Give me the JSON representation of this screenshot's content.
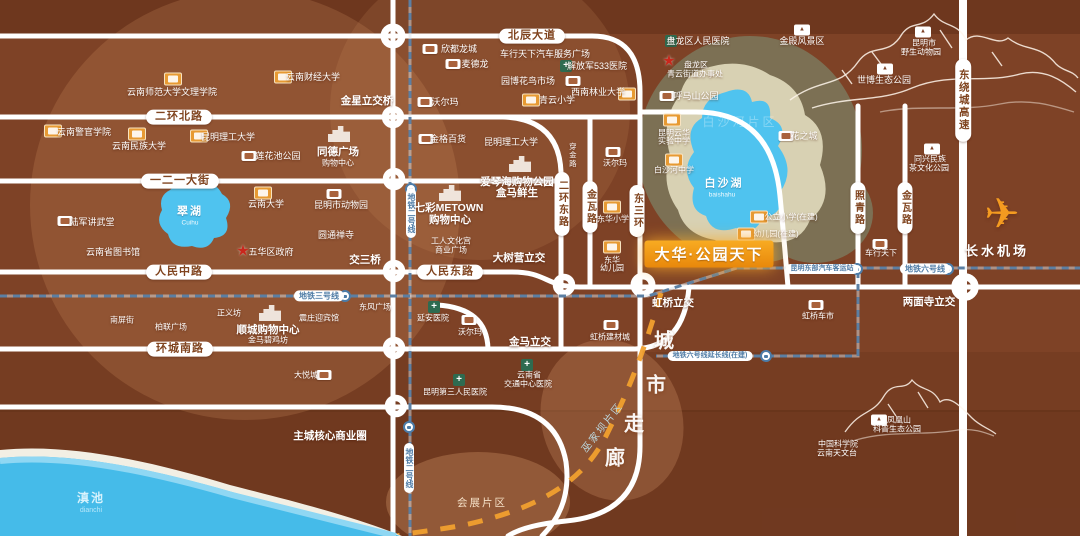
{
  "project": {
    "name": "大华·公园天下"
  },
  "colors": {
    "base": "#7e4226",
    "road": "#ffffff",
    "metro_dash": "#9db3c9",
    "corridor_dash": "#f1a02e",
    "lake_blue": "#4fc3ef",
    "dianchi_blue": "#45bbe9",
    "banner_orange": "#f0930e",
    "olive_ring": "#7c7054",
    "cream_ring": "#d8d1b3",
    "school_icon": "#e79a33",
    "hospital_icon": "#2e6b50",
    "star_icon": "#c9271c"
  },
  "labels": [
    {
      "t": "北辰大道",
      "x": 532,
      "y": 36,
      "c": "pill-h",
      "n": "road-label-beichen-avenue"
    },
    {
      "t": "二环北路",
      "x": 179,
      "y": 117,
      "c": "pill-h",
      "n": "road-label-erhuan-north"
    },
    {
      "t": "一二一大街",
      "x": 180,
      "y": 181,
      "c": "pill-h",
      "n": "road-label-121-street"
    },
    {
      "t": "人民中路",
      "x": 179,
      "y": 272,
      "c": "pill-h",
      "n": "road-label-renmin-middle"
    },
    {
      "t": "人民东路",
      "x": 450,
      "y": 272,
      "c": "pill-h",
      "n": "road-label-renmin-east"
    },
    {
      "t": "环城南路",
      "x": 180,
      "y": 349,
      "c": "pill-h",
      "n": "road-label-huancheng-south"
    },
    {
      "t": "二环东路",
      "x": 562,
      "y": 204,
      "c": "pill-v",
      "n": "road-label-erhuan-east"
    },
    {
      "t": "金瓦路",
      "x": 590,
      "y": 207,
      "c": "pill-v",
      "n": "road-label-jinwa-west"
    },
    {
      "t": "东三环",
      "x": 637,
      "y": 211,
      "c": "pill-v",
      "n": "road-label-dongsanhuan"
    },
    {
      "t": "照青路",
      "x": 858,
      "y": 208,
      "c": "pill-v",
      "n": "road-label-zhaoqing"
    },
    {
      "t": "金瓦路",
      "x": 905,
      "y": 208,
      "c": "pill-v",
      "n": "road-label-jinwa-east"
    },
    {
      "t": "东绕城高速",
      "x": 963,
      "y": 100,
      "c": "pill-v hw",
      "n": "road-label-east-ring-expressway"
    },
    {
      "t": "穿金路",
      "x": 572,
      "y": 155,
      "c": "v-text",
      "n": "road-label-chuanjin"
    },
    {
      "t": "金星立交桥",
      "x": 367,
      "y": 101,
      "c": "md",
      "n": "interchange-jinxing"
    },
    {
      "t": "交三桥",
      "x": 365,
      "y": 260,
      "c": "md",
      "n": "interchange-jiaosanqiao"
    },
    {
      "t": "大树营立交",
      "x": 519,
      "y": 258,
      "c": "md",
      "n": "interchange-dashuying"
    },
    {
      "t": "金马立交",
      "x": 530,
      "y": 342,
      "c": "md",
      "n": "interchange-jinma"
    },
    {
      "t": "虹桥立交",
      "x": 673,
      "y": 303,
      "c": "md",
      "n": "interchange-hongqiao"
    },
    {
      "t": "两面寺立交",
      "x": 929,
      "y": 302,
      "c": "md",
      "n": "interchange-liangmiansi"
    },
    {
      "t": "主城核心商业圈",
      "x": 330,
      "y": 436,
      "c": "md",
      "n": "main-city-core-business-circle"
    },
    {
      "t": "地铁三号线",
      "x": 319,
      "y": 296,
      "c": "metro-pill",
      "n": "metro-line3-label"
    },
    {
      "t": "地铁二号线",
      "x": 411,
      "y": 213,
      "c": "metro-v",
      "n": "metro-line2-label"
    },
    {
      "t": "地铁二号线",
      "x": 409,
      "y": 468,
      "c": "metro-v",
      "n": "metro-line2-label-south"
    },
    {
      "t": "昆明东部汽车客运站",
      "x": 822,
      "y": 269,
      "c": "metro-pill tiny",
      "n": "east-bus-station-label"
    },
    {
      "t": "地铁六号线",
      "x": 925,
      "y": 269,
      "c": "metro-pill",
      "n": "metro-line6-label"
    },
    {
      "t": "地铁六号线延长线(在建)",
      "x": 710,
      "y": 356,
      "c": "metro-pill tiny",
      "n": "metro-line6-extension-label"
    },
    {
      "t": "云南师范大学文理学院",
      "x": 172,
      "y": 92,
      "n": "poi-ynnu-arts-science"
    },
    {
      "t": "云南财经大学",
      "x": 313,
      "y": 77,
      "n": "poi-yufe"
    },
    {
      "t": "云南警官学院",
      "x": 84,
      "y": 132,
      "n": "poi-yunnan-police-college"
    },
    {
      "t": "云南民族大学",
      "x": 139,
      "y": 146,
      "n": "poi-yunnan-minzu-univ"
    },
    {
      "t": "昆明理工大学",
      "x": 228,
      "y": 137,
      "n": "poi-kust"
    },
    {
      "t": "莲花池公园",
      "x": 278,
      "y": 156,
      "n": "poi-lianhuachi-park"
    },
    {
      "t": "同德广场",
      "x": 338,
      "y": 152,
      "c": "md",
      "n": "poi-tongde-plaza"
    },
    {
      "t": "购物中心",
      "x": 338,
      "y": 163,
      "c": "sm",
      "n": "poi-tongde-mall"
    },
    {
      "t": "欣都龙城",
      "x": 459,
      "y": 49,
      "n": "poi-xindu-longcheng"
    },
    {
      "t": "麦德龙",
      "x": 475,
      "y": 64,
      "n": "poi-metro-market"
    },
    {
      "t": "车行天下汽车服务广场",
      "x": 545,
      "y": 54,
      "n": "poi-auto-service-plaza"
    },
    {
      "t": "解放军533医院",
      "x": 597,
      "y": 66,
      "n": "poi-pla-533-hospital"
    },
    {
      "t": "园博花鸟市场",
      "x": 528,
      "y": 81,
      "n": "poi-yuanbo-flower-bird-market"
    },
    {
      "t": "青云小学",
      "x": 557,
      "y": 100,
      "n": "poi-qingyun-primary"
    },
    {
      "t": "西南林业大学",
      "x": 598,
      "y": 92,
      "n": "poi-swfu"
    },
    {
      "t": "呼马山公园",
      "x": 696,
      "y": 96,
      "n": "poi-humashan-park"
    },
    {
      "t": "盘龙区人民医院",
      "x": 698,
      "y": 41,
      "n": "poi-panlong-peoples-hospital"
    },
    {
      "t": "盘龙区",
      "x": 696,
      "y": 65,
      "c": "sm",
      "n": "poi-panlong-district"
    },
    {
      "t": "青云街道办事处",
      "x": 695,
      "y": 74,
      "c": "sm",
      "n": "poi-qingyun-subdistrict-office"
    },
    {
      "t": "沃尔玛",
      "x": 445,
      "y": 102,
      "n": "poi-walmart-north"
    },
    {
      "t": "金格百货",
      "x": 448,
      "y": 139,
      "n": "poi-jinge-department-store"
    },
    {
      "t": "昆明理工大学",
      "x": 511,
      "y": 142,
      "n": "poi-kust-campus2"
    },
    {
      "t": "金殿风景区",
      "x": 802,
      "y": 41,
      "n": "poi-golden-temple-scenic"
    },
    {
      "t": "昆明市",
      "x": 924,
      "y": 43,
      "c": "sm",
      "n": "poi-kunming-city"
    },
    {
      "t": "野生动物园",
      "x": 921,
      "y": 52,
      "c": "sm",
      "n": "poi-wildlife-park"
    },
    {
      "t": "世博生态公园",
      "x": 884,
      "y": 80,
      "n": "poi-expo-eco-park"
    },
    {
      "t": "花之城",
      "x": 804,
      "y": 136,
      "n": "poi-flower-city"
    },
    {
      "t": "同兴民族",
      "x": 930,
      "y": 159,
      "c": "sm",
      "n": "poi-tongxing-minzu"
    },
    {
      "t": "茶文化公园",
      "x": 929,
      "y": 168,
      "c": "sm",
      "n": "poi-tea-culture-park"
    },
    {
      "t": "陆军讲武堂",
      "x": 92,
      "y": 222,
      "n": "poi-army-academy"
    },
    {
      "t": "翠湖",
      "x": 190,
      "y": 212,
      "c": "lake",
      "n": "lake-label-cuihu"
    },
    {
      "t": "Cuihu",
      "x": 190,
      "y": 223,
      "c": "latin",
      "n": "lake-label-cuihu-pinyin"
    },
    {
      "t": "云南大学",
      "x": 266,
      "y": 204,
      "n": "poi-yunnan-university"
    },
    {
      "t": "昆明市动物园",
      "x": 341,
      "y": 205,
      "n": "poi-kunming-zoo"
    },
    {
      "t": "云南省图书馆",
      "x": 113,
      "y": 252,
      "n": "poi-yunnan-library"
    },
    {
      "t": "五华区政府",
      "x": 271,
      "y": 252,
      "n": "poi-wuhua-district-gov"
    },
    {
      "t": "圆通禅寺",
      "x": 336,
      "y": 235,
      "n": "poi-yuantong-temple"
    },
    {
      "t": "七彩METOWN",
      "x": 449,
      "y": 208,
      "c": "md",
      "n": "poi-qicai-metown"
    },
    {
      "t": "购物中心",
      "x": 450,
      "y": 220,
      "c": "md",
      "n": "poi-metown-mall"
    },
    {
      "t": "爱琴海购物公园",
      "x": 517,
      "y": 182,
      "c": "md",
      "n": "poi-aegean-shopping-park"
    },
    {
      "t": "盒马鲜生",
      "x": 517,
      "y": 193,
      "c": "md",
      "n": "poi-hema-fresh"
    },
    {
      "t": "工人文化宫",
      "x": 451,
      "y": 241,
      "c": "sm",
      "n": "poi-workers-culture-palace"
    },
    {
      "t": "商业广场",
      "x": 451,
      "y": 250,
      "c": "sm",
      "n": "poi-business-plaza"
    },
    {
      "t": "昆明云华",
      "x": 674,
      "y": 133,
      "c": "sm",
      "n": "poi-yunhua-line1"
    },
    {
      "t": "实验中学",
      "x": 674,
      "y": 141,
      "c": "sm",
      "n": "poi-yunhua-experimental-school"
    },
    {
      "t": "白沙河中学",
      "x": 674,
      "y": 170,
      "c": "sm",
      "n": "poi-baishahe-middle-school"
    },
    {
      "t": "白沙湖",
      "x": 724,
      "y": 184,
      "c": "lake",
      "n": "lake-label-baishahu"
    },
    {
      "t": "baishahu",
      "x": 722,
      "y": 195,
      "c": "latin",
      "n": "lake-label-baishahu-pinyin"
    },
    {
      "t": "公立小学(在建)",
      "x": 791,
      "y": 217,
      "c": "sm",
      "n": "poi-public-primary-under-construction"
    },
    {
      "t": "幼儿园(在建)",
      "x": 776,
      "y": 234,
      "c": "sm",
      "n": "poi-kindergarten-under-construction"
    },
    {
      "t": "沃尔玛",
      "x": 615,
      "y": 163,
      "c": "sm",
      "n": "poi-walmart-east"
    },
    {
      "t": "东华小学",
      "x": 613,
      "y": 219,
      "c": "sm",
      "n": "poi-donghua-primary"
    },
    {
      "t": "东华",
      "x": 612,
      "y": 260,
      "c": "sm",
      "n": "poi-donghua"
    },
    {
      "t": "幼儿园",
      "x": 612,
      "y": 268,
      "c": "sm",
      "n": "poi-donghua-kindergarten"
    },
    {
      "t": "车行天下",
      "x": 881,
      "y": 253,
      "c": "sm",
      "n": "poi-chexing-tianxia"
    },
    {
      "t": "长水机场",
      "x": 997,
      "y": 252,
      "c": "airport",
      "n": "poi-changshui-airport"
    },
    {
      "t": "虹桥车市",
      "x": 818,
      "y": 316,
      "c": "sm",
      "n": "poi-hongqiao-auto-market"
    },
    {
      "t": "虹桥建材城",
      "x": 610,
      "y": 337,
      "c": "sm",
      "n": "poi-hongqiao-building-materials"
    },
    {
      "t": "东风广场",
      "x": 375,
      "y": 307,
      "c": "sm",
      "n": "poi-dongfeng-square"
    },
    {
      "t": "延安医院",
      "x": 433,
      "y": 318,
      "c": "sm",
      "n": "poi-yanan-hospital"
    },
    {
      "t": "沃尔玛",
      "x": 470,
      "y": 332,
      "c": "sm",
      "n": "poi-walmart-south"
    },
    {
      "t": "云南省",
      "x": 529,
      "y": 375,
      "c": "sm",
      "n": "poi-yunnan-province"
    },
    {
      "t": "交通中心医院",
      "x": 528,
      "y": 384,
      "c": "sm",
      "n": "poi-traffic-central-hospital"
    },
    {
      "t": "昆明第三人民医院",
      "x": 455,
      "y": 392,
      "c": "sm",
      "n": "poi-kunming-third-peoples-hospital"
    },
    {
      "t": "南屏街",
      "x": 122,
      "y": 320,
      "c": "sm",
      "n": "poi-nanping-street"
    },
    {
      "t": "柏联广场",
      "x": 171,
      "y": 327,
      "c": "sm",
      "n": "poi-bolian-plaza"
    },
    {
      "t": "正义坊",
      "x": 229,
      "y": 313,
      "c": "sm",
      "n": "poi-zhengyifang"
    },
    {
      "t": "顺城购物中心",
      "x": 268,
      "y": 330,
      "c": "md",
      "n": "poi-shuncheng-mall"
    },
    {
      "t": "金马碧鸡坊",
      "x": 268,
      "y": 340,
      "c": "sm",
      "n": "poi-jinma-biji-archways"
    },
    {
      "t": "震庄迎宾馆",
      "x": 319,
      "y": 318,
      "c": "sm",
      "n": "poi-zhenzhuang-guesthouse"
    },
    {
      "t": "大悦城",
      "x": 306,
      "y": 375,
      "c": "sm",
      "n": "poi-joy-city"
    },
    {
      "t": "凤凰山",
      "x": 899,
      "y": 420,
      "c": "sm",
      "n": "poi-fenghuangshan"
    },
    {
      "t": "科普生态公园",
      "x": 897,
      "y": 429,
      "c": "sm",
      "n": "poi-science-eco-park"
    },
    {
      "t": "中国科学院",
      "x": 838,
      "y": 444,
      "c": "sm",
      "n": "poi-cas"
    },
    {
      "t": "云南天文台",
      "x": 837,
      "y": 453,
      "c": "sm",
      "n": "poi-yunnan-observatory"
    },
    {
      "t": "滇池",
      "x": 91,
      "y": 499,
      "c": "dian",
      "n": "lake-label-dianchi"
    },
    {
      "t": "dianchi",
      "x": 91,
      "y": 511,
      "c": "dian-latin",
      "n": "lake-label-dianchi-pinyin"
    },
    {
      "t": "会展片区",
      "x": 482,
      "y": 503,
      "c": "district",
      "n": "district-label-huizhan"
    },
    {
      "t": "巫家坝片区",
      "x": 603,
      "y": 428,
      "c": "corridor-area",
      "r": -52,
      "n": "district-label-wujiaba"
    },
    {
      "t": "白沙河片区",
      "x": 740,
      "y": 123,
      "c": "watermark",
      "n": "district-label-baishahe"
    },
    {
      "t": "城",
      "x": 664,
      "y": 342,
      "c": "corridor-ch",
      "n": "corridor-char-cheng"
    },
    {
      "t": "市",
      "x": 656,
      "y": 386,
      "c": "corridor-ch",
      "n": "corridor-char-shi"
    },
    {
      "t": "走",
      "x": 634,
      "y": 425,
      "c": "corridor-ch",
      "n": "corridor-char-zou"
    },
    {
      "t": "廊",
      "x": 615,
      "y": 459,
      "c": "corridor-ch",
      "n": "corridor-char-lang"
    }
  ],
  "icons": [
    {
      "t": "orange",
      "x": 173,
      "y": 79,
      "n": "school-icon"
    },
    {
      "t": "orange",
      "x": 283,
      "y": 77,
      "n": "school-icon"
    },
    {
      "t": "orange",
      "x": 53,
      "y": 131,
      "n": "school-icon"
    },
    {
      "t": "orange",
      "x": 137,
      "y": 134,
      "n": "school-icon"
    },
    {
      "t": "orange",
      "x": 199,
      "y": 136,
      "n": "school-icon"
    },
    {
      "t": "orange",
      "x": 263,
      "y": 193,
      "n": "school-icon"
    },
    {
      "t": "orange",
      "x": 531,
      "y": 100,
      "n": "school-icon"
    },
    {
      "t": "orange",
      "x": 627,
      "y": 94,
      "n": "school-icon"
    },
    {
      "t": "orange",
      "x": 672,
      "y": 120,
      "n": "school-icon"
    },
    {
      "t": "orange",
      "x": 674,
      "y": 160,
      "n": "school-icon"
    },
    {
      "t": "orange",
      "x": 612,
      "y": 207,
      "n": "school-icon"
    },
    {
      "t": "orange",
      "x": 612,
      "y": 247,
      "n": "school-icon"
    },
    {
      "t": "orange",
      "x": 759,
      "y": 217,
      "n": "school-icon"
    },
    {
      "t": "orange",
      "x": 746,
      "y": 234,
      "n": "school-icon"
    },
    {
      "t": "white",
      "x": 249,
      "y": 156,
      "n": "park-icon"
    },
    {
      "t": "white",
      "x": 430,
      "y": 49,
      "n": "mall-icon"
    },
    {
      "t": "white",
      "x": 453,
      "y": 64,
      "n": "mall-icon"
    },
    {
      "t": "white",
      "x": 573,
      "y": 81,
      "n": "market-icon"
    },
    {
      "t": "white",
      "x": 667,
      "y": 96,
      "n": "park-icon"
    },
    {
      "t": "white",
      "x": 425,
      "y": 102,
      "n": "mall-icon"
    },
    {
      "t": "white",
      "x": 426,
      "y": 139,
      "n": "mall-icon"
    },
    {
      "t": "white",
      "x": 334,
      "y": 194,
      "n": "zoo-icon"
    },
    {
      "t": "white",
      "x": 65,
      "y": 221,
      "n": "landmark-icon"
    },
    {
      "t": "white",
      "x": 786,
      "y": 136,
      "n": "mall-icon"
    },
    {
      "t": "white",
      "x": 613,
      "y": 152,
      "n": "mall-icon"
    },
    {
      "t": "white",
      "x": 880,
      "y": 244,
      "n": "mall-icon"
    },
    {
      "t": "white",
      "x": 816,
      "y": 305,
      "n": "market-icon"
    },
    {
      "t": "white",
      "x": 611,
      "y": 325,
      "n": "market-icon"
    },
    {
      "t": "white",
      "x": 469,
      "y": 320,
      "n": "mall-icon"
    },
    {
      "t": "white",
      "x": 324,
      "y": 375,
      "n": "mall-icon"
    },
    {
      "t": "mtn",
      "x": 802,
      "y": 30,
      "n": "mountain-park-icon"
    },
    {
      "t": "mtn",
      "x": 923,
      "y": 32,
      "n": "mountain-park-icon"
    },
    {
      "t": "mtn",
      "x": 885,
      "y": 69,
      "n": "mountain-park-icon"
    },
    {
      "t": "mtn",
      "x": 932,
      "y": 149,
      "n": "mountain-park-icon"
    },
    {
      "t": "mtn",
      "x": 879,
      "y": 420,
      "n": "mountain-park-icon"
    },
    {
      "t": "green",
      "x": 566,
      "y": 66,
      "n": "hospital-icon"
    },
    {
      "t": "green",
      "x": 671,
      "y": 41,
      "n": "hospital-icon"
    },
    {
      "t": "green",
      "x": 434,
      "y": 307,
      "n": "hospital-icon"
    },
    {
      "t": "green",
      "x": 527,
      "y": 365,
      "n": "hospital-icon"
    },
    {
      "t": "green",
      "x": 459,
      "y": 380,
      "n": "hospital-icon"
    },
    {
      "t": "star",
      "x": 669,
      "y": 61,
      "n": "government-star-icon"
    },
    {
      "t": "star",
      "x": 243,
      "y": 251,
      "n": "government-star-icon"
    },
    {
      "t": "building",
      "x": 339,
      "y": 134,
      "n": "mall-building-icon"
    },
    {
      "t": "building",
      "x": 450,
      "y": 193,
      "n": "mall-building-icon"
    },
    {
      "t": "building",
      "x": 520,
      "y": 164,
      "n": "mall-building-icon"
    },
    {
      "t": "building",
      "x": 270,
      "y": 313,
      "n": "mall-building-icon"
    },
    {
      "t": "metro",
      "x": 345,
      "y": 296,
      "n": "metro-icon"
    },
    {
      "t": "metro",
      "x": 411,
      "y": 189,
      "n": "metro-icon"
    },
    {
      "t": "metro",
      "x": 409,
      "y": 427,
      "n": "metro-icon"
    },
    {
      "t": "metro",
      "x": 857,
      "y": 269,
      "n": "metro-icon"
    },
    {
      "t": "metro",
      "x": 948,
      "y": 269,
      "n": "metro-icon"
    },
    {
      "t": "metro",
      "x": 766,
      "y": 356,
      "n": "metro-icon"
    },
    {
      "t": "plane",
      "x": 1002,
      "y": 214,
      "n": "airplane-icon"
    }
  ]
}
